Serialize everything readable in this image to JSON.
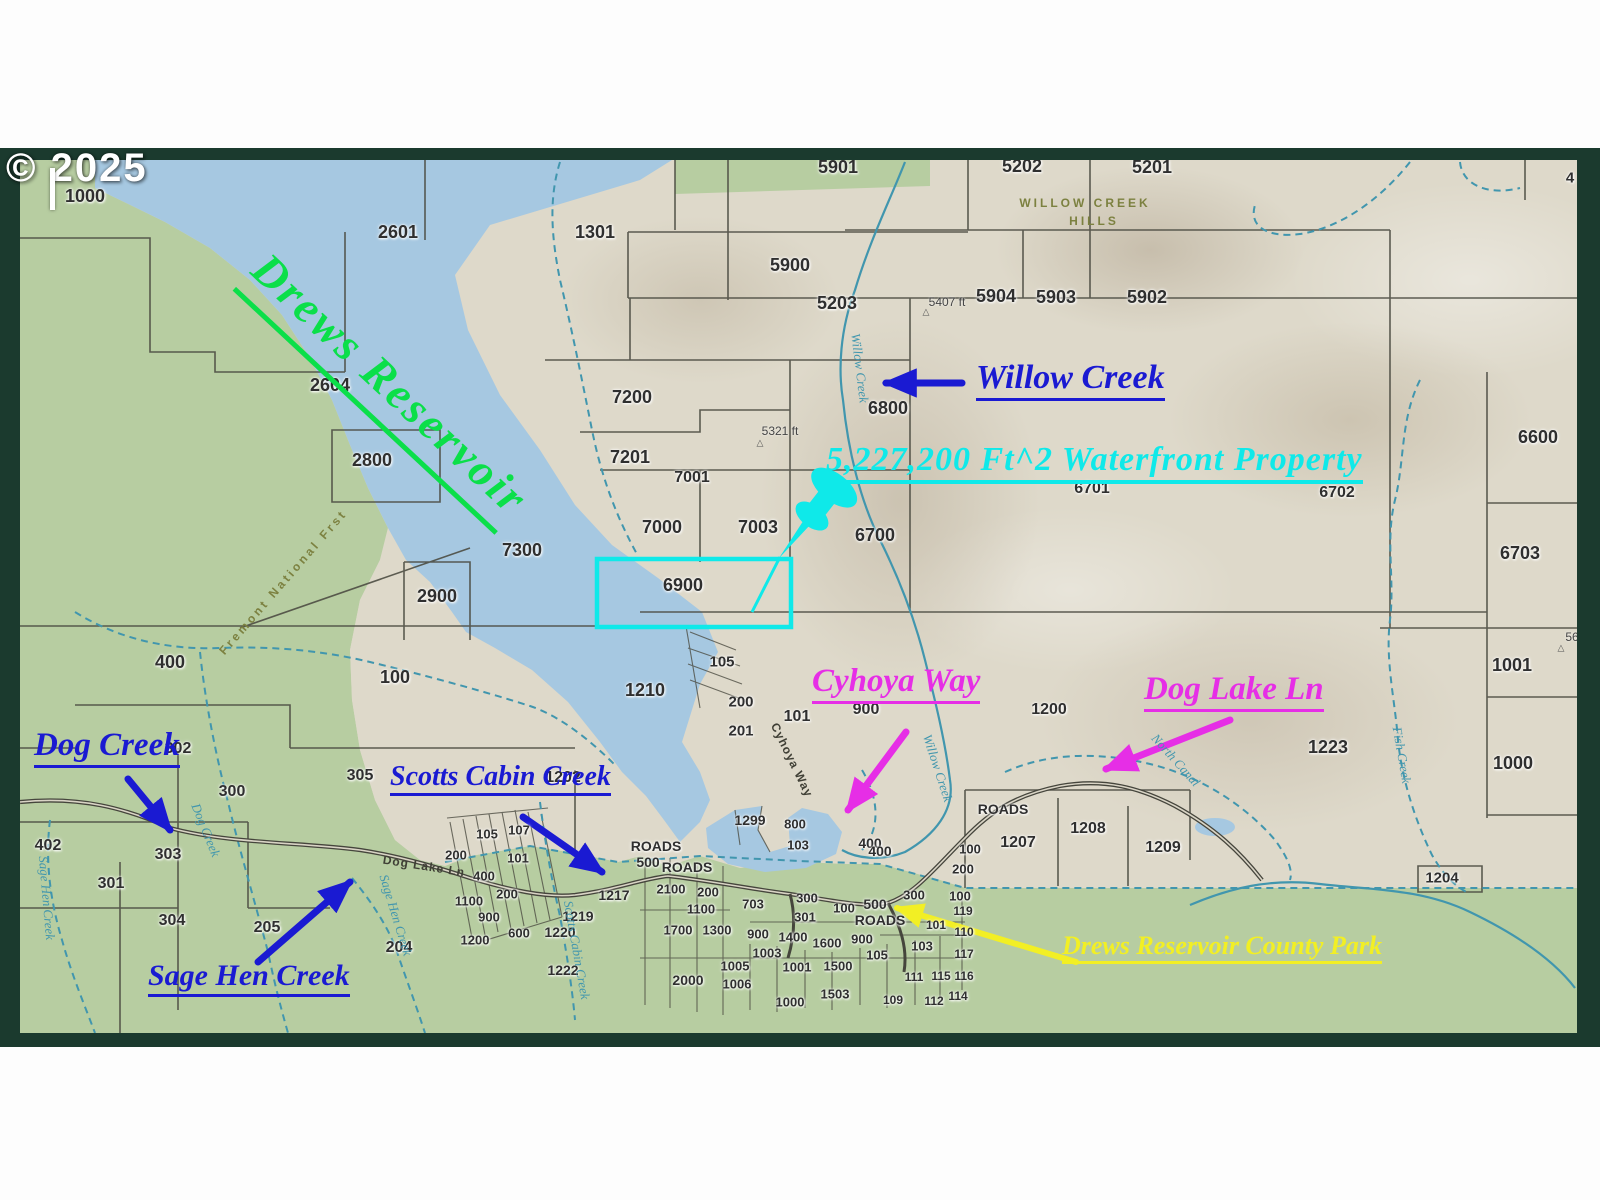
{
  "copyright": "© 2025",
  "colors": {
    "frame": "#1b3a2e",
    "water": "#a6c8e1",
    "land_green": "#b7cda1",
    "terrain_tan": "#ded9ca",
    "parcel_line": "#4c4c42",
    "creek": "#4196ae",
    "road": "#45453c",
    "annotation_blue": "#1a1ad2",
    "annotation_magenta": "#e62ee6",
    "annotation_cyan": "#0fe9e9",
    "annotation_yellow": "#f2ef24",
    "annotation_green": "#0bdf49",
    "watermark": "#ffffff"
  },
  "annotations": {
    "drews_reservoir": {
      "text": "Drews Reservoir",
      "color": "#0bdf49"
    },
    "waterfront": {
      "text": "5,227,200 Ft^2  Waterfront Property",
      "color": "#0fe9e9"
    },
    "willow_creek": {
      "text": "Willow Creek",
      "color": "#1a1ad2"
    },
    "dog_creek": {
      "text": "Dog Creek",
      "color": "#1a1ad2"
    },
    "scotts_cabin_creek": {
      "text": "Scotts Cabin Creek",
      "color": "#1a1ad2"
    },
    "sage_hen_creek": {
      "text": "Sage Hen Creek",
      "color": "#1a1ad2"
    },
    "cyhoya_way": {
      "text": "Cyhoya Way",
      "color": "#e62ee6"
    },
    "dog_lake_ln": {
      "text": "Dog Lake Ln",
      "color": "#e62ee6"
    },
    "county_park": {
      "text": "Drews Reservoir County Park",
      "color": "#f2ef24"
    }
  },
  "parcel_labels": [
    {
      "t": "1000",
      "x": 85,
      "y": 196
    },
    {
      "t": "2601",
      "x": 398,
      "y": 232
    },
    {
      "t": "1301",
      "x": 595,
      "y": 232
    },
    {
      "t": "5901",
      "x": 838,
      "y": 167
    },
    {
      "t": "5202",
      "x": 1022,
      "y": 166
    },
    {
      "t": "5201",
      "x": 1152,
      "y": 167
    },
    {
      "t": "4",
      "x": 1570,
      "y": 178,
      "s": 15
    },
    {
      "t": "5900",
      "x": 790,
      "y": 265
    },
    {
      "t": "5203",
      "x": 837,
      "y": 303
    },
    {
      "t": "5904",
      "x": 996,
      "y": 296
    },
    {
      "t": "5903",
      "x": 1056,
      "y": 297
    },
    {
      "t": "5902",
      "x": 1147,
      "y": 297
    },
    {
      "t": "2604",
      "x": 330,
      "y": 385
    },
    {
      "t": "7200",
      "x": 632,
      "y": 397
    },
    {
      "t": "6800",
      "x": 888,
      "y": 408
    },
    {
      "t": "2800",
      "x": 372,
      "y": 460
    },
    {
      "t": "7201",
      "x": 630,
      "y": 457
    },
    {
      "t": "7001",
      "x": 692,
      "y": 478,
      "s": 16
    },
    {
      "t": "6600",
      "x": 1538,
      "y": 437
    },
    {
      "t": "6701",
      "x": 1092,
      "y": 489,
      "s": 16
    },
    {
      "t": "6702",
      "x": 1337,
      "y": 493,
      "s": 16
    },
    {
      "t": "7000",
      "x": 662,
      "y": 527
    },
    {
      "t": "7003",
      "x": 758,
      "y": 527
    },
    {
      "t": "6700",
      "x": 875,
      "y": 535
    },
    {
      "t": "7300",
      "x": 522,
      "y": 550
    },
    {
      "t": "6703",
      "x": 1520,
      "y": 553
    },
    {
      "t": "2900",
      "x": 437,
      "y": 596
    },
    {
      "t": "6900",
      "x": 683,
      "y": 585
    },
    {
      "t": "1001",
      "x": 1512,
      "y": 665
    },
    {
      "t": "400",
      "x": 170,
      "y": 662
    },
    {
      "t": "100",
      "x": 395,
      "y": 677
    },
    {
      "t": "1210",
      "x": 645,
      "y": 690
    },
    {
      "t": "105",
      "x": 722,
      "y": 662,
      "s": 15
    },
    {
      "t": "200",
      "x": 741,
      "y": 702,
      "s": 15
    },
    {
      "t": "201",
      "x": 741,
      "y": 731,
      "s": 15
    },
    {
      "t": "101",
      "x": 797,
      "y": 717,
      "s": 16
    },
    {
      "t": "900",
      "x": 866,
      "y": 710,
      "s": 16
    },
    {
      "t": "1200",
      "x": 1049,
      "y": 710,
      "s": 16
    },
    {
      "t": "1223",
      "x": 1328,
      "y": 747
    },
    {
      "t": "1000",
      "x": 1513,
      "y": 763
    },
    {
      "t": "302",
      "x": 178,
      "y": 749,
      "s": 16
    },
    {
      "t": "300",
      "x": 232,
      "y": 792,
      "s": 16
    },
    {
      "t": "305",
      "x": 360,
      "y": 776,
      "s": 16
    },
    {
      "t": "1202",
      "x": 563,
      "y": 778,
      "s": 16
    },
    {
      "t": "402",
      "x": 48,
      "y": 846,
      "s": 16
    },
    {
      "t": "303",
      "x": 168,
      "y": 855,
      "s": 16
    },
    {
      "t": "301",
      "x": 111,
      "y": 884,
      "s": 16
    },
    {
      "t": "304",
      "x": 172,
      "y": 921,
      "s": 16
    },
    {
      "t": "205",
      "x": 267,
      "y": 928,
      "s": 16
    },
    {
      "t": "204",
      "x": 399,
      "y": 948,
      "s": 16
    },
    {
      "t": "105",
      "x": 487,
      "y": 834,
      "s": 13
    },
    {
      "t": "107",
      "x": 519,
      "y": 830,
      "s": 13
    },
    {
      "t": "200",
      "x": 456,
      "y": 855,
      "s": 13
    },
    {
      "t": "101",
      "x": 518,
      "y": 858,
      "s": 13
    },
    {
      "t": "400",
      "x": 484,
      "y": 876,
      "s": 13
    },
    {
      "t": "200",
      "x": 507,
      "y": 894,
      "s": 13
    },
    {
      "t": "1100",
      "x": 469,
      "y": 901,
      "s": 13
    },
    {
      "t": "900",
      "x": 489,
      "y": 917,
      "s": 13
    },
    {
      "t": "600",
      "x": 519,
      "y": 933,
      "s": 13
    },
    {
      "t": "1200",
      "x": 475,
      "y": 940,
      "s": 13
    },
    {
      "t": "1217",
      "x": 614,
      "y": 895,
      "s": 14
    },
    {
      "t": "1219",
      "x": 578,
      "y": 916,
      "s": 14
    },
    {
      "t": "1220",
      "x": 560,
      "y": 932,
      "s": 14
    },
    {
      "t": "1222",
      "x": 563,
      "y": 970,
      "s": 14
    },
    {
      "t": "ROADS",
      "x": 656,
      "y": 846,
      "s": 14
    },
    {
      "t": "500",
      "x": 648,
      "y": 862,
      "s": 14
    },
    {
      "t": "ROADS",
      "x": 687,
      "y": 867,
      "s": 14
    },
    {
      "t": "2100",
      "x": 671,
      "y": 889,
      "s": 13
    },
    {
      "t": "200",
      "x": 708,
      "y": 892,
      "s": 13
    },
    {
      "t": "1100",
      "x": 701,
      "y": 909,
      "s": 13
    },
    {
      "t": "1700",
      "x": 678,
      "y": 930,
      "s": 13
    },
    {
      "t": "1300",
      "x": 717,
      "y": 930,
      "s": 13
    },
    {
      "t": "703",
      "x": 753,
      "y": 904,
      "s": 13
    },
    {
      "t": "900",
      "x": 758,
      "y": 934,
      "s": 13
    },
    {
      "t": "1400",
      "x": 793,
      "y": 937,
      "s": 13
    },
    {
      "t": "300",
      "x": 807,
      "y": 898,
      "s": 13
    },
    {
      "t": "301",
      "x": 805,
      "y": 917,
      "s": 13
    },
    {
      "t": "100",
      "x": 844,
      "y": 908,
      "s": 13
    },
    {
      "t": "1600",
      "x": 827,
      "y": 943,
      "s": 13
    },
    {
      "t": "900",
      "x": 862,
      "y": 939,
      "s": 13
    },
    {
      "t": "1003",
      "x": 767,
      "y": 953,
      "s": 13
    },
    {
      "t": "1005",
      "x": 735,
      "y": 966,
      "s": 13
    },
    {
      "t": "1001",
      "x": 797,
      "y": 967,
      "s": 13
    },
    {
      "t": "1006",
      "x": 737,
      "y": 984,
      "s": 13
    },
    {
      "t": "2000",
      "x": 688,
      "y": 980,
      "s": 14
    },
    {
      "t": "1500",
      "x": 838,
      "y": 966,
      "s": 13
    },
    {
      "t": "1503",
      "x": 835,
      "y": 994,
      "s": 13
    },
    {
      "t": "1000",
      "x": 790,
      "y": 1002,
      "s": 13
    },
    {
      "t": "1299",
      "x": 750,
      "y": 820,
      "s": 14
    },
    {
      "t": "800",
      "x": 795,
      "y": 824,
      "s": 13
    },
    {
      "t": "103",
      "x": 798,
      "y": 845,
      "s": 13
    },
    {
      "t": "400",
      "x": 870,
      "y": 843,
      "s": 14
    },
    {
      "t": "105",
      "x": 877,
      "y": 955,
      "s": 13
    },
    {
      "t": "103",
      "x": 922,
      "y": 946,
      "s": 13
    },
    {
      "t": "111",
      "x": 914,
      "y": 977,
      "s": 12
    },
    {
      "t": "115",
      "x": 941,
      "y": 976,
      "s": 12
    },
    {
      "t": "116",
      "x": 964,
      "y": 976,
      "s": 12
    },
    {
      "t": "117",
      "x": 964,
      "y": 954,
      "s": 12
    },
    {
      "t": "109",
      "x": 893,
      "y": 1000,
      "s": 12
    },
    {
      "t": "112",
      "x": 934,
      "y": 1001,
      "s": 12
    },
    {
      "t": "114",
      "x": 958,
      "y": 996,
      "s": 12
    },
    {
      "t": "500",
      "x": 875,
      "y": 904,
      "s": 14
    },
    {
      "t": "ROADS",
      "x": 880,
      "y": 920,
      "s": 14
    },
    {
      "t": "300",
      "x": 914,
      "y": 895,
      "s": 13
    },
    {
      "t": "100",
      "x": 960,
      "y": 896,
      "s": 13
    },
    {
      "t": "200",
      "x": 963,
      "y": 869,
      "s": 13
    },
    {
      "t": "119",
      "x": 963,
      "y": 911,
      "s": 12
    },
    {
      "t": "101",
      "x": 936,
      "y": 925,
      "s": 12
    },
    {
      "t": "110",
      "x": 964,
      "y": 932,
      "s": 12
    },
    {
      "t": "400",
      "x": 880,
      "y": 851,
      "s": 14
    },
    {
      "t": "100",
      "x": 970,
      "y": 849,
      "s": 13
    },
    {
      "t": "1207",
      "x": 1018,
      "y": 843,
      "s": 16
    },
    {
      "t": "1208",
      "x": 1088,
      "y": 829,
      "s": 16
    },
    {
      "t": "1209",
      "x": 1163,
      "y": 848,
      "s": 16
    },
    {
      "t": "ROADS",
      "x": 1003,
      "y": 809,
      "s": 14
    },
    {
      "t": "1204",
      "x": 1442,
      "y": 878,
      "s": 15
    }
  ],
  "creek_labels": [
    {
      "t": "Willow Creek",
      "x": 860,
      "y": 368,
      "r": 83
    },
    {
      "t": "Willow Creek",
      "x": 938,
      "y": 768,
      "r": 72
    },
    {
      "t": "Scotts Cabin Creek",
      "x": 577,
      "y": 950,
      "r": 80
    },
    {
      "t": "Sage Hen Creek",
      "x": 47,
      "y": 898,
      "r": 85
    },
    {
      "t": "Sage Hen Creek",
      "x": 396,
      "y": 915,
      "r": 73
    },
    {
      "t": "Dog Creek",
      "x": 206,
      "y": 830,
      "r": 68
    },
    {
      "t": "North Canal",
      "x": 1176,
      "y": 760,
      "r": 48
    },
    {
      "t": "Fish Creek",
      "x": 1402,
      "y": 755,
      "r": 80
    }
  ],
  "road_labels": [
    {
      "t": "Dog Lake Ln",
      "x": 424,
      "y": 866,
      "r": 9
    },
    {
      "t": "Cyhoya Way",
      "x": 792,
      "y": 760,
      "r": 64
    }
  ],
  "place_labels": [
    {
      "t": "WILLOW CREEK",
      "x": 1085,
      "y": 203
    },
    {
      "t": "HILLS",
      "x": 1094,
      "y": 221
    },
    {
      "t": "Fremont National Frst",
      "x": 283,
      "y": 582,
      "r": -49
    }
  ],
  "elevations": [
    {
      "t": "5407 ft",
      "x": 947,
      "y": 302,
      "tx": 926,
      "ty": 312
    },
    {
      "t": "5321 ft",
      "x": 780,
      "y": 431,
      "tx": 760,
      "ty": 443
    },
    {
      "t": "56",
      "x": 1572,
      "y": 637,
      "tx": 1561,
      "ty": 648
    }
  ]
}
